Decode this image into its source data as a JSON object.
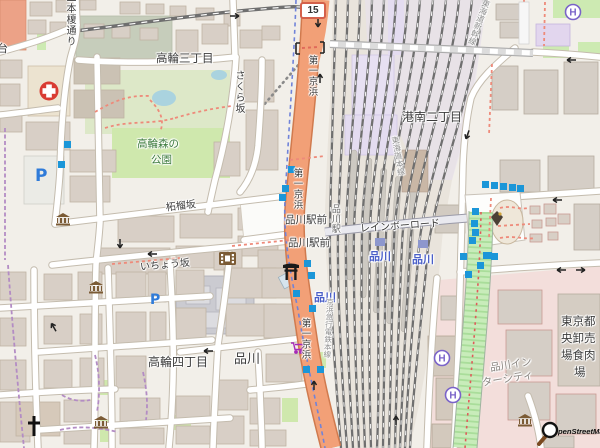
{
  "map": {
    "attribution_text": "penStreetMap",
    "route_shield": "15",
    "labels": {
      "takanawa_3chome": "高輪三丁目",
      "konan_2chome": "港南二丁目",
      "takanawa_4chome": "高輪四丁目",
      "shinagawa_district": "品川",
      "takanawa_mori_park_line1": "高輪森の",
      "takanawa_mori_park_line2": "公園",
      "shinagawa_ekimae_1": "品川駅前",
      "shinagawa_ekimae_2": "品川駅前",
      "shinagawa_station_blue_west": "品川",
      "shinagawa_station_blue_jr": "品川",
      "shinagawa_station_blue_east": "品川",
      "shinagawa_station_vertical": "品川駅",
      "rainbow_road": "レインボーロード",
      "daiichi_keihin_north": "第一京浜",
      "daiichi_keihin_mid": "第一京浜",
      "daiichi_keihin_south": "第一京浜",
      "zakurozaka": "柘榴坂",
      "ichozaka": "いちょう坂",
      "sakurazaka": "さくら坂",
      "nihon_enoki_dori": "二本榎通り",
      "dai_partial": "台",
      "keikyu_main_line": "京浜急行電鉄本線",
      "tokaido_main_line": "東海道本線",
      "tokaido_shinkansen": "東海道新幹線",
      "intercity_line1": "品川イン",
      "intercity_line2": "ターシティ",
      "meat_market_line1": "東京都",
      "meat_market_line2": "央卸売",
      "meat_market_line3": "場食肉",
      "meat_market_line4": "場"
    },
    "glyphs": {
      "parking": "P",
      "helipad": "H"
    },
    "colors": {
      "trunk_road": "#f2a077",
      "park_green": "#cdebb0",
      "water": "#aad3df",
      "rail_yard": "#e9e4dc",
      "retail_pink": "#f3dedb",
      "bus_stop_blue": "#1b96d8",
      "station_label_blue": "#4a5fc8",
      "boundary_purple": "#ad6eac",
      "hospital_red": "#d93b32",
      "poi_brown": "#7b5b35"
    }
  }
}
